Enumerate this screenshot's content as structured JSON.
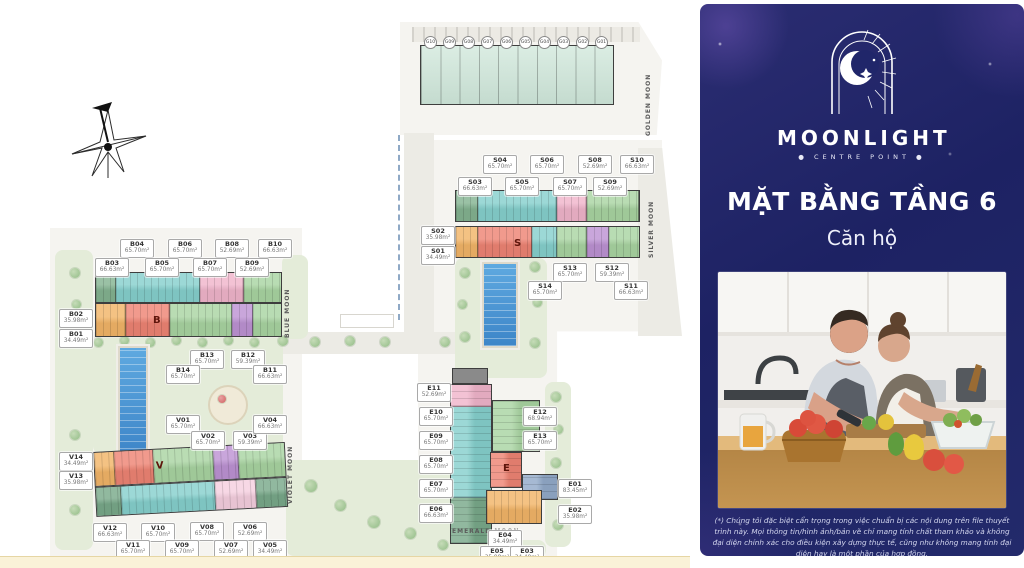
{
  "panel": {
    "brand": {
      "name": "MOONLIGHT",
      "tagline": "● CENTRE POINT ●"
    },
    "title": "MẶT BẰNG TẦNG 6",
    "subtitle": "Căn hộ",
    "disclaimer": "(*) Chúng tôi đặc biệt cẩn trọng trong việc chuẩn bị các nội dung trên file thuyết trình này. Mọi thông tin/hình ảnh/bản vẽ chỉ mang tính chất tham khảo và không đại diện chính xác cho điều kiện xây dựng thực tế, cũng như không mang tính đại diện hay là một phần của hợp đồng."
  },
  "plan": {
    "wings": {
      "golden": "GOLDEN MOON",
      "silver": "SILVER MOON",
      "blue": "BLUE MOON",
      "violet": "VIOLET MOON",
      "emerald": "EMERALD MOON"
    },
    "block_letters": {
      "b": "B",
      "s": "S",
      "v": "V",
      "e": "E"
    },
    "g_units": [
      "G10",
      "G09",
      "G08",
      "G07",
      "G06",
      "G05",
      "G04",
      "G03",
      "G02",
      "G01"
    ],
    "s_units": [
      {
        "id": "S01",
        "area": "34.49m²"
      },
      {
        "id": "S02",
        "area": "35.98m²"
      },
      {
        "id": "S03",
        "area": "66.63m²"
      },
      {
        "id": "S04",
        "area": "65.70m²"
      },
      {
        "id": "S05",
        "area": "65.70m²"
      },
      {
        "id": "S06",
        "area": "65.70m²"
      },
      {
        "id": "S07",
        "area": "65.70m²"
      },
      {
        "id": "S08",
        "area": "52.69m²"
      },
      {
        "id": "S09",
        "area": "52.69m²"
      },
      {
        "id": "S10",
        "area": "66.63m²"
      },
      {
        "id": "S11",
        "area": "66.63m²"
      },
      {
        "id": "S12",
        "area": "59.39m²"
      },
      {
        "id": "S13",
        "area": "65.70m²"
      },
      {
        "id": "S14",
        "area": "65.70m²"
      }
    ],
    "b_units": [
      {
        "id": "B01",
        "area": "34.49m²"
      },
      {
        "id": "B02",
        "area": "35.98m²"
      },
      {
        "id": "B03",
        "area": "66.63m²"
      },
      {
        "id": "B04",
        "area": "65.70m²"
      },
      {
        "id": "B05",
        "area": "65.70m²"
      },
      {
        "id": "B06",
        "area": "65.70m²"
      },
      {
        "id": "B07",
        "area": "65.70m²"
      },
      {
        "id": "B08",
        "area": "52.69m²"
      },
      {
        "id": "B09",
        "area": "52.69m²"
      },
      {
        "id": "B10",
        "area": "66.63m²"
      },
      {
        "id": "B11",
        "area": "66.63m²"
      },
      {
        "id": "B12",
        "area": "59.39m²"
      },
      {
        "id": "B13",
        "area": "65.70m²"
      },
      {
        "id": "B14",
        "area": "65.70m²"
      }
    ],
    "v_units": [
      {
        "id": "V01",
        "area": "65.70m²"
      },
      {
        "id": "V02",
        "area": "65.70m²"
      },
      {
        "id": "V03",
        "area": "59.39m²"
      },
      {
        "id": "V04",
        "area": "66.63m²"
      },
      {
        "id": "V05",
        "area": "34.49m²"
      },
      {
        "id": "V06",
        "area": "52.69m²"
      },
      {
        "id": "V07",
        "area": "52.69m²"
      },
      {
        "id": "V08",
        "area": "65.70m²"
      },
      {
        "id": "V09",
        "area": "65.70m²"
      },
      {
        "id": "V10",
        "area": "65.70m²"
      },
      {
        "id": "V11",
        "area": "65.70m²"
      },
      {
        "id": "V12",
        "area": "66.63m²"
      },
      {
        "id": "V13",
        "area": "35.98m²"
      },
      {
        "id": "V14",
        "area": "34.49m²"
      }
    ],
    "e_units": [
      {
        "id": "E01",
        "area": "83.45m²"
      },
      {
        "id": "E02",
        "area": "35.98m²"
      },
      {
        "id": "E03",
        "area": "34.49m²"
      },
      {
        "id": "E04",
        "area": "34.49m²"
      },
      {
        "id": "E05",
        "area": "35.98m²"
      },
      {
        "id": "E06",
        "area": "66.63m²"
      },
      {
        "id": "E07",
        "area": "65.70m²"
      },
      {
        "id": "E08",
        "area": "65.70m²"
      },
      {
        "id": "E09",
        "area": "65.70m²"
      },
      {
        "id": "E10",
        "area": "65.70m²"
      },
      {
        "id": "E11",
        "area": "52.69m²"
      },
      {
        "id": "E12",
        "area": "68.94m²"
      },
      {
        "id": "E13",
        "area": "65.70m²"
      }
    ]
  },
  "colors": {
    "panel_navy": "#1d2263",
    "unit_teal": "#86d0cd",
    "unit_pink": "#f0b5cb",
    "unit_green": "#a9d4a2",
    "unit_orange": "#f2b568",
    "unit_red": "#ee8474",
    "unit_purple": "#bd93d3",
    "unit_mint": "#cfe7da",
    "pool_blue": "#3d85c8",
    "bottom_bar": "#faf2d8"
  }
}
